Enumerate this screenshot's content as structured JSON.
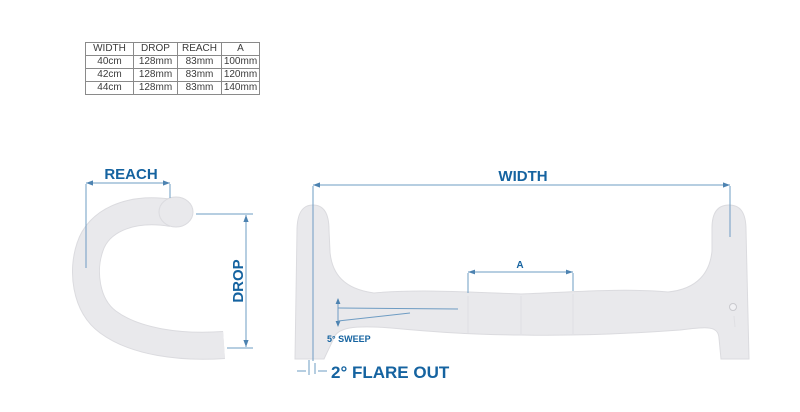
{
  "spec_table": {
    "headers": [
      "WIDTH",
      "DROP",
      "REACH",
      "A"
    ],
    "rows": [
      [
        "40cm",
        "128mm",
        "83mm",
        "100mm"
      ],
      [
        "42cm",
        "128mm",
        "83mm",
        "120mm"
      ],
      [
        "44cm",
        "128mm",
        "83mm",
        "140mm"
      ]
    ]
  },
  "side_view": {
    "reach_label": "REACH",
    "drop_label": "DROP"
  },
  "front_view": {
    "width_label": "WIDTH",
    "a_label": "A",
    "sweep_label": "5° SWEEP",
    "flare_label": "2° FLARE OUT"
  },
  "colors": {
    "background": "#ffffff",
    "label_blue": "#1563a0",
    "dim_line": "#6e9cc3",
    "dim_arrow": "#4d83b1",
    "bar_fill": "#e9e9ec",
    "bar_edge": "#dbdbdf",
    "table_border": "#8a8a8a",
    "table_text": "#3b3b3b"
  }
}
